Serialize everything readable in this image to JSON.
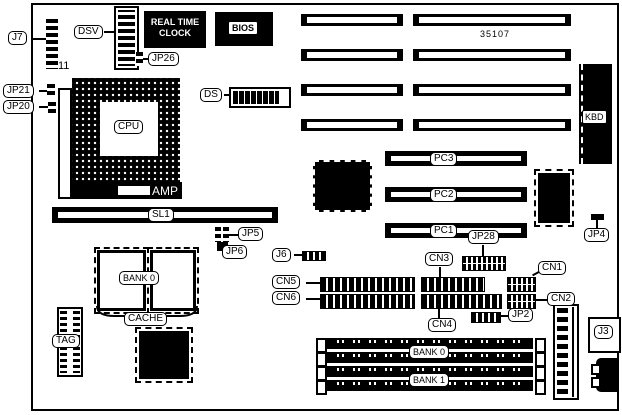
{
  "board": {
    "part_number": "35107",
    "labels": {
      "j7": "J7",
      "j7_pin": "11",
      "dsv": "DSV",
      "rtc_line1": "REAL TIME",
      "rtc_line2": "CLOCK",
      "bios": "BIOS",
      "jp26": "JP26",
      "jp21": "JP21",
      "jp20": "JP20",
      "cpu": "CPU",
      "amp": "AMP",
      "ds": "DS",
      "kbd": "KBD",
      "sl1": "SL1",
      "jp5": "JP5",
      "jp6": "JP6",
      "j6": "J6",
      "bank0_cache": "BANK 0",
      "cache": "CACHE",
      "tag": "TAG",
      "cn1": "CN1",
      "cn2": "CN2",
      "cn3": "CN3",
      "cn4": "CN4",
      "cn5": "CN5",
      "cn6": "CN6",
      "pc1": "PC1",
      "pc2": "PC2",
      "pc3": "PC3",
      "jp28": "JP28",
      "jp2": "JP2",
      "jp4": "JP4",
      "bank0_simm": "BANK 0",
      "bank1_simm": "BANK 1",
      "j3": "J3"
    }
  }
}
